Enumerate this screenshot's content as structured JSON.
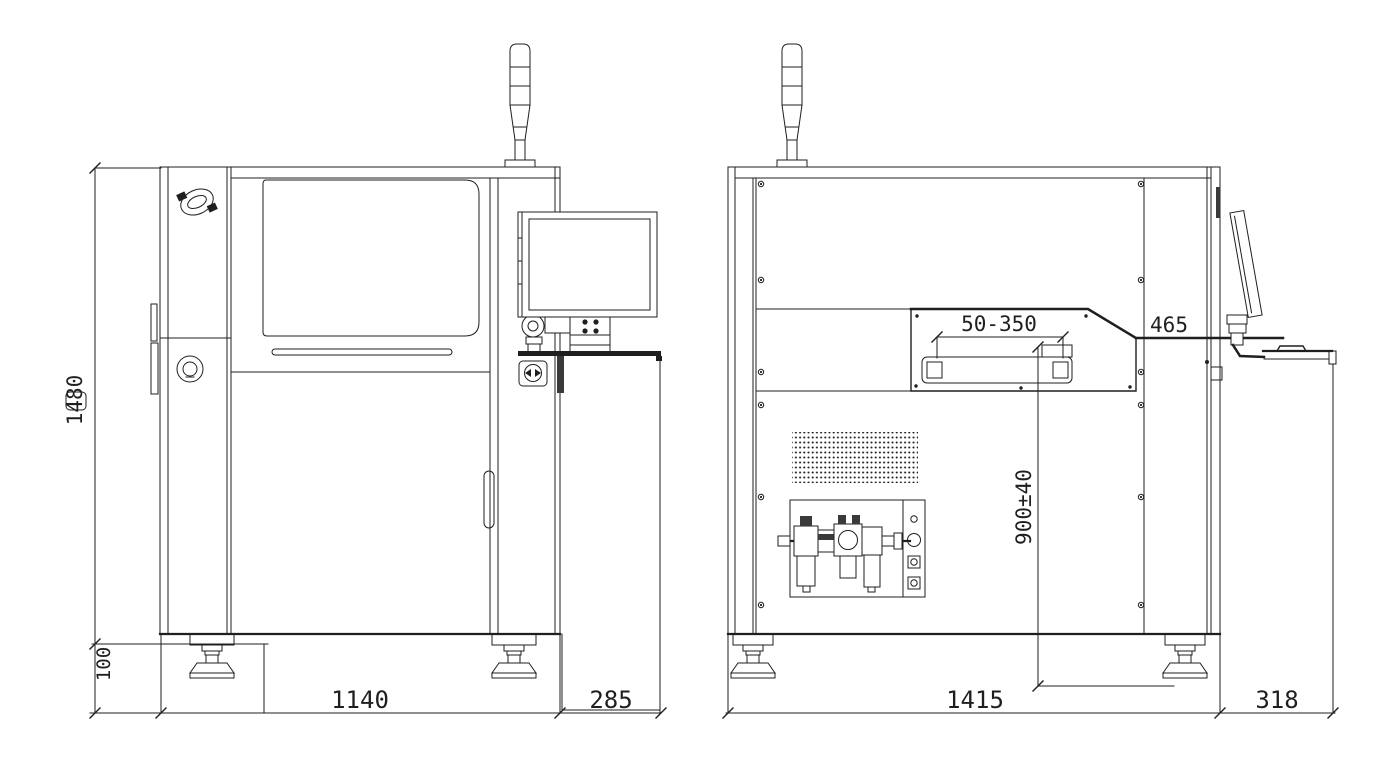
{
  "page": {
    "background": "#ffffff",
    "line_color": "#1f1f1f"
  },
  "drawing": {
    "views": {
      "front": {
        "dimensions": {
          "overall_height": "1480",
          "base_foot_height": "100",
          "body_width": "1140",
          "stand_width": "285"
        }
      },
      "side": {
        "dimensions": {
          "conveyor_width_range": "50-350",
          "rear_offset": "465",
          "conveyor_height": "900±40",
          "body_depth": "1415",
          "tray_offset": "318"
        }
      }
    }
  }
}
